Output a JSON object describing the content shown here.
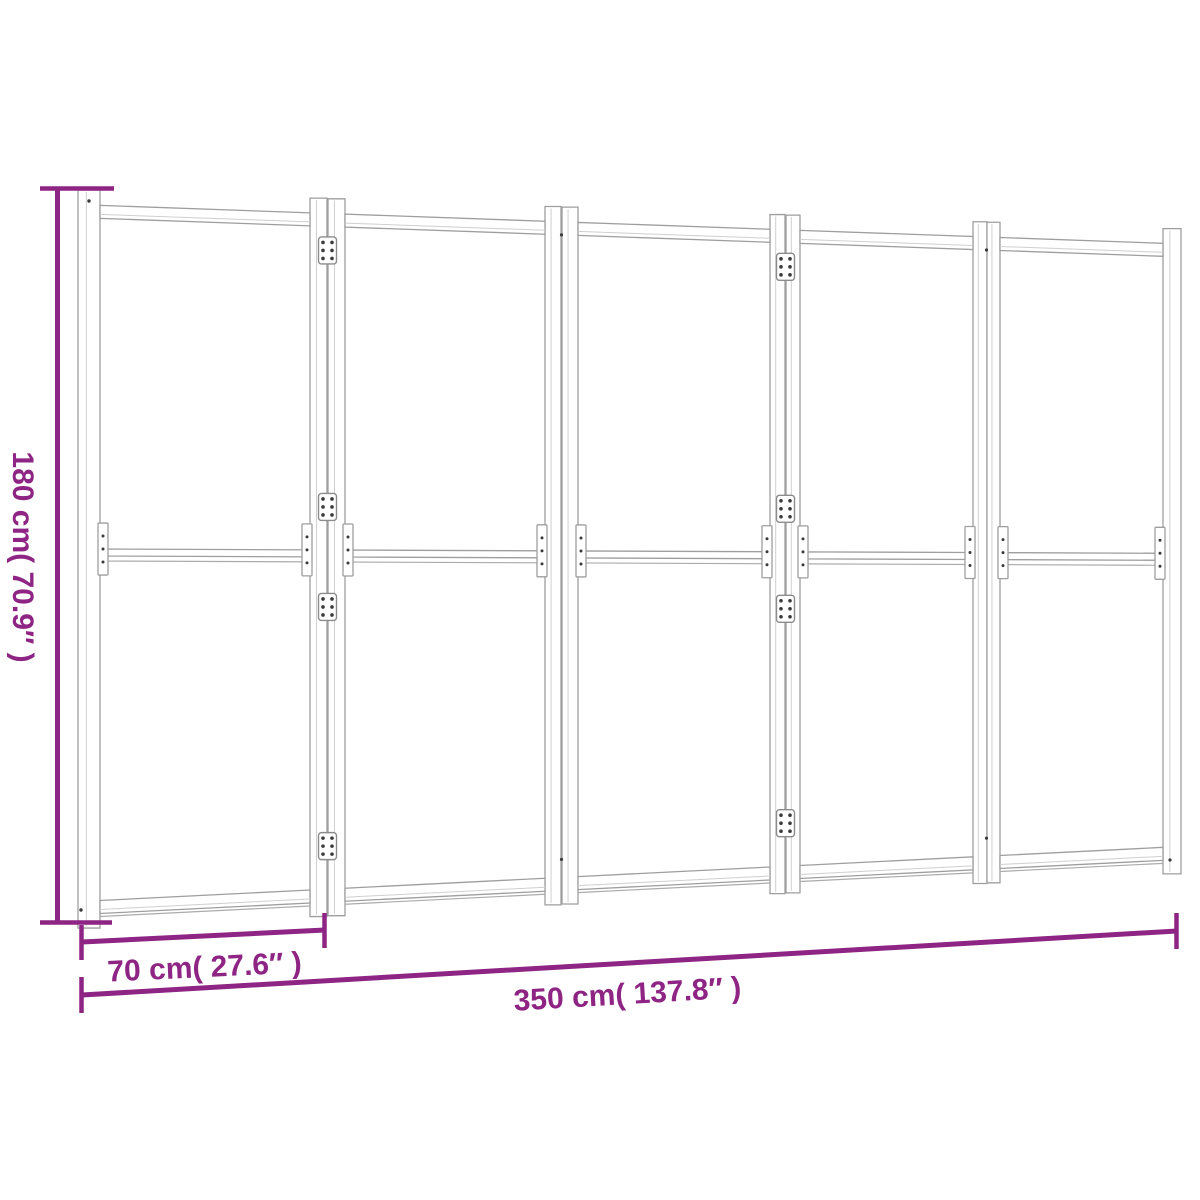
{
  "diagram": {
    "panel_count": 5,
    "labels": {
      "height": "180 cm( 70.9″ )",
      "panel_width": "70 cm( 27.6″ )",
      "total_width": "350 cm( 137.8″ )"
    },
    "values": {
      "height_cm": 180,
      "height_in": 70.9,
      "panel_width_cm": 70,
      "panel_width_in": 27.6,
      "total_width_cm": 350,
      "total_width_in": 137.8
    },
    "colors": {
      "dimension": "#8E2483",
      "frame": "#9E9E9E",
      "frame_light": "#CFCFCF"
    }
  }
}
